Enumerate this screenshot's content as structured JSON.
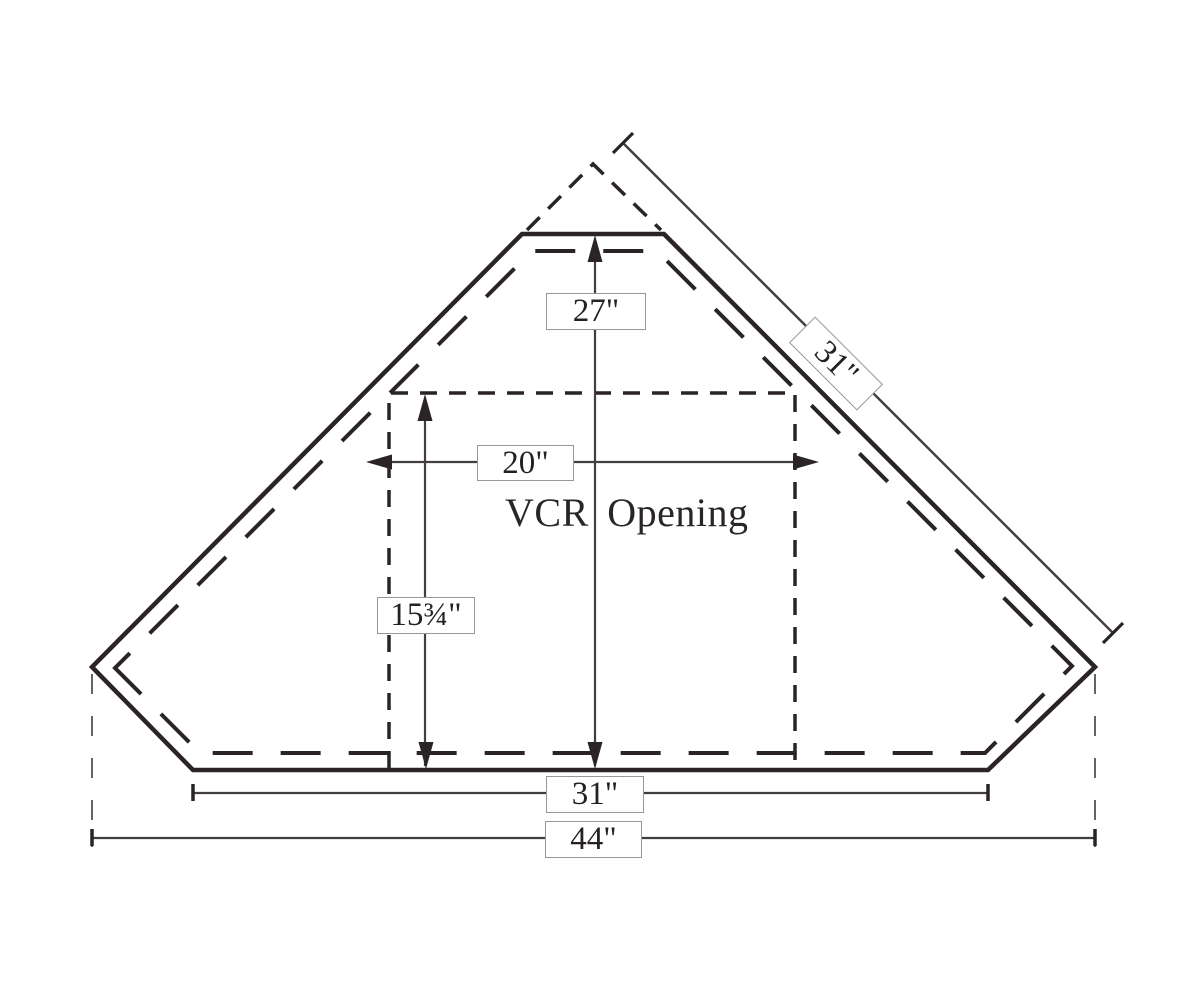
{
  "figure": {
    "opening_label": "VCR Opening",
    "dimensions": {
      "depth_center": "27\"",
      "back_right_edge": "31\"",
      "opening_width": "20\"",
      "opening_depth": "15¾\"",
      "front_edge": "31\"",
      "overall_width": "44\""
    },
    "colors": {
      "ink": "#2a2424",
      "thin_line": "#433e3e",
      "label_border": "#999693",
      "background": "#ffffff"
    }
  }
}
